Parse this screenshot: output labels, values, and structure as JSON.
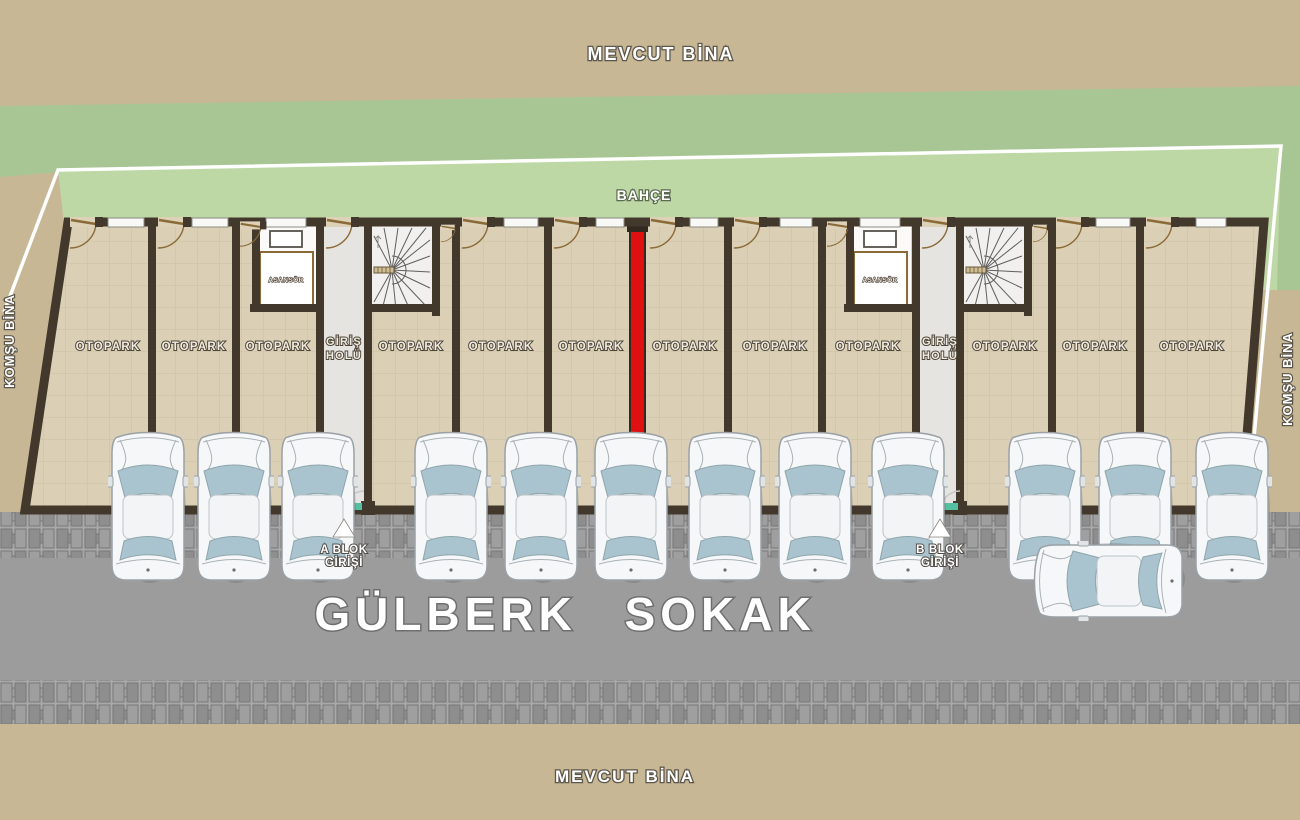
{
  "surroundings": {
    "top_building": "MEVCUT BİNA",
    "bottom_building": "MEVCUT BİNA",
    "left_building": "KOMŞU BİNA",
    "right_building": "KOMŞU BİNA",
    "garden": "BAHÇE",
    "street": "GÜLBERK SOKAK"
  },
  "entrances": {
    "a_block": {
      "line1": "A BLOK",
      "line2": "GİRİŞİ"
    },
    "b_block": {
      "line1": "B BLOK",
      "line2": "GİRİŞİ"
    }
  },
  "halls": {
    "a": {
      "line1": "GİRİŞ",
      "line2": "HOLÜ"
    },
    "b": {
      "line1": "GİRİŞ",
      "line2": "HOLÜ"
    }
  },
  "elevators": {
    "a": "ASANSÖR",
    "b": "ASANSÖR"
  },
  "parking": {
    "spaces": [
      {
        "label": "OTOPARK"
      },
      {
        "label": "OTOPARK"
      },
      {
        "label": "OTOPARK"
      },
      {
        "label": "OTOPARK"
      },
      {
        "label": "OTOPARK"
      },
      {
        "label": "OTOPARK"
      },
      {
        "label": "OTOPARK"
      },
      {
        "label": "OTOPARK"
      },
      {
        "label": "OTOPARK"
      },
      {
        "label": "OTOPARK"
      },
      {
        "label": "OTOPARK"
      },
      {
        "label": "OTOPARK"
      }
    ]
  },
  "colors": {
    "background_tan": "#c7b795",
    "garden_dark_green": "#a8c694",
    "garden_light_green": "#bdd8a5",
    "floor_beige": "#dbcfb5",
    "wall_dark": "#43382c",
    "firewall_red": "#e01010",
    "street_gray": "#9c9c9c",
    "hall_gray": "#e6e4e1",
    "threshold_teal": "#54c0a2",
    "boundary_white": "#ffffff",
    "door_brown": "#8a6b38",
    "car_window_blue": "#a9c4ce"
  }
}
